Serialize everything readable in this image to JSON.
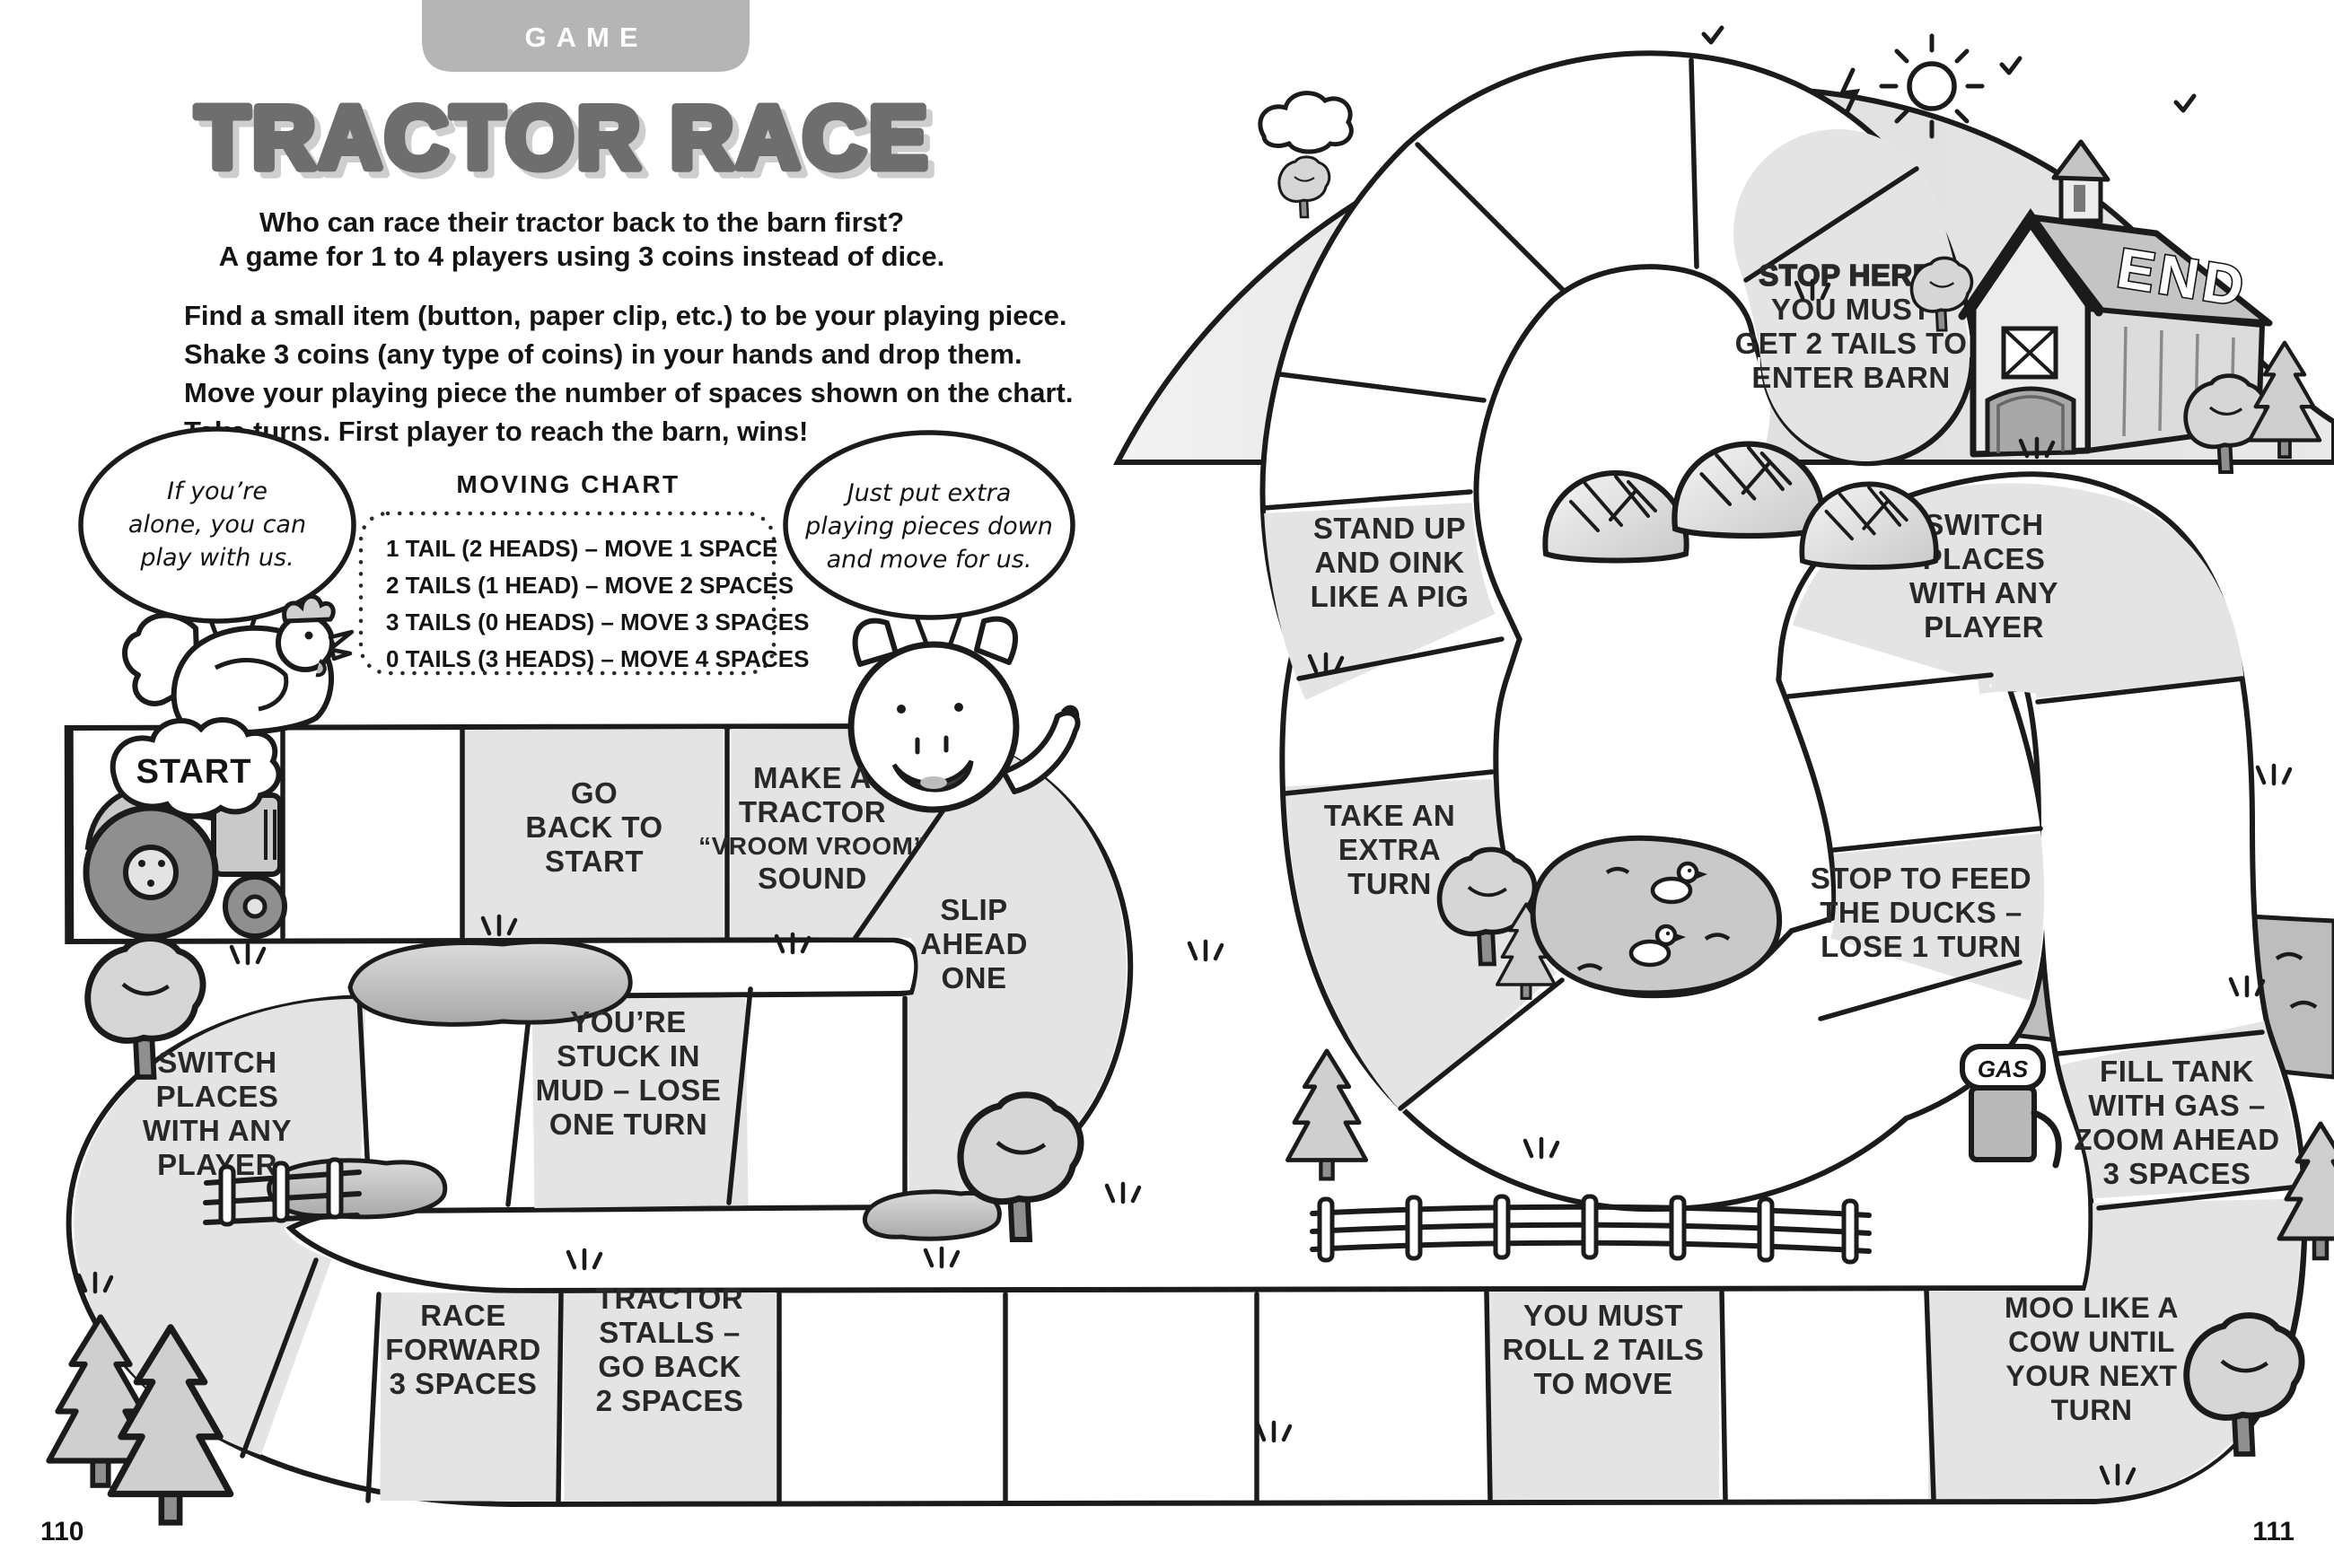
{
  "page": {
    "left_number": "110",
    "right_number": "111"
  },
  "header": {
    "badge": "GAME",
    "title": "TRACTOR RACE",
    "intro": [
      "Who can race their tractor back to the barn first?",
      "A game for 1 to 4 players using 3 coins instead of dice."
    ],
    "instructions": [
      "Find a small item (button, paper clip, etc.) to be your playing piece.",
      "Shake 3 coins (any type of coins) in your hands and drop them.",
      "Move your playing piece the number of spaces shown on the chart.",
      "Take turns. First player to reach the barn, wins!"
    ]
  },
  "moving_chart": {
    "title": "MOVING CHART",
    "rows": [
      "1 TAIL (2 HEADS) – MOVE 1 SPACE",
      "2 TAILS (1 HEAD) – MOVE 2 SPACES",
      "3 TAILS (0 HEADS) – MOVE 3 SPACES",
      "0 TAILS (3 HEADS) – MOVE 4 SPACES"
    ]
  },
  "bubbles": {
    "chicken": {
      "lines": [
        "If you’re",
        "alone, you can",
        "play with us."
      ]
    },
    "pig": {
      "lines": [
        "Just put extra",
        "playing pieces down",
        "and move for us."
      ]
    }
  },
  "board": {
    "start": "START",
    "end": "END",
    "gas": "GAS",
    "spaces": [
      {
        "name": "go-back-to-start",
        "lines": [
          "GO",
          "BACK TO",
          "START"
        ]
      },
      {
        "name": "make-tractor-sound",
        "lines": [
          "MAKE A",
          "TRACTOR",
          "“VROOM VROOM”",
          "SOUND"
        ]
      },
      {
        "name": "slip-ahead-one",
        "lines": [
          "SLIP",
          "AHEAD",
          "ONE"
        ]
      },
      {
        "name": "stuck-in-mud",
        "lines": [
          "YOU’RE",
          "STUCK IN",
          "MUD – LOSE",
          "ONE TURN"
        ]
      },
      {
        "name": "switch-places-left",
        "lines": [
          "SWITCH",
          "PLACES",
          "WITH ANY",
          "PLAYER"
        ]
      },
      {
        "name": "race-forward",
        "lines": [
          "RACE",
          "FORWARD",
          "3 SPACES"
        ]
      },
      {
        "name": "tractor-stalls",
        "lines": [
          "TRACTOR",
          "STALLS –",
          "GO BACK",
          "2 SPACES"
        ]
      },
      {
        "name": "roll-2-tails",
        "lines": [
          "YOU MUST",
          "ROLL 2 TAILS",
          "TO MOVE"
        ]
      },
      {
        "name": "moo-like-cow",
        "lines": [
          "MOO LIKE A",
          "COW UNTIL",
          "YOUR NEXT",
          "TURN"
        ]
      },
      {
        "name": "fill-tank",
        "lines": [
          "FILL TANK",
          "WITH GAS –",
          "ZOOM AHEAD",
          "3 SPACES"
        ]
      },
      {
        "name": "switch-places-right",
        "lines": [
          "SWITCH",
          "PLACES",
          "WITH ANY",
          "PLAYER"
        ]
      },
      {
        "name": "feed-ducks",
        "lines": [
          "STOP TO FEED",
          "THE DUCKS –",
          "LOSE 1 TURN"
        ]
      },
      {
        "name": "extra-turn",
        "lines": [
          "TAKE AN",
          "EXTRA",
          "TURN"
        ]
      },
      {
        "name": "oink-like-pig",
        "lines": [
          "STAND UP",
          "AND OINK",
          "LIKE A PIG"
        ]
      },
      {
        "name": "stop-here",
        "lines": [
          "STOP HERE!",
          "YOU MUST",
          "GET 2 TAILS TO",
          "ENTER BARN"
        ]
      }
    ]
  },
  "colors": {
    "ink": "#1b1b1b",
    "title_gray": "#6e6e6e",
    "title_shadow": "#cecece",
    "badge_gray": "#b5b5b5",
    "space_gray": "#e4e4e4",
    "hill_gray": "#e2e2e2",
    "water_gray": "#bdbdbd",
    "wheel_gray": "#8f8f8f"
  }
}
